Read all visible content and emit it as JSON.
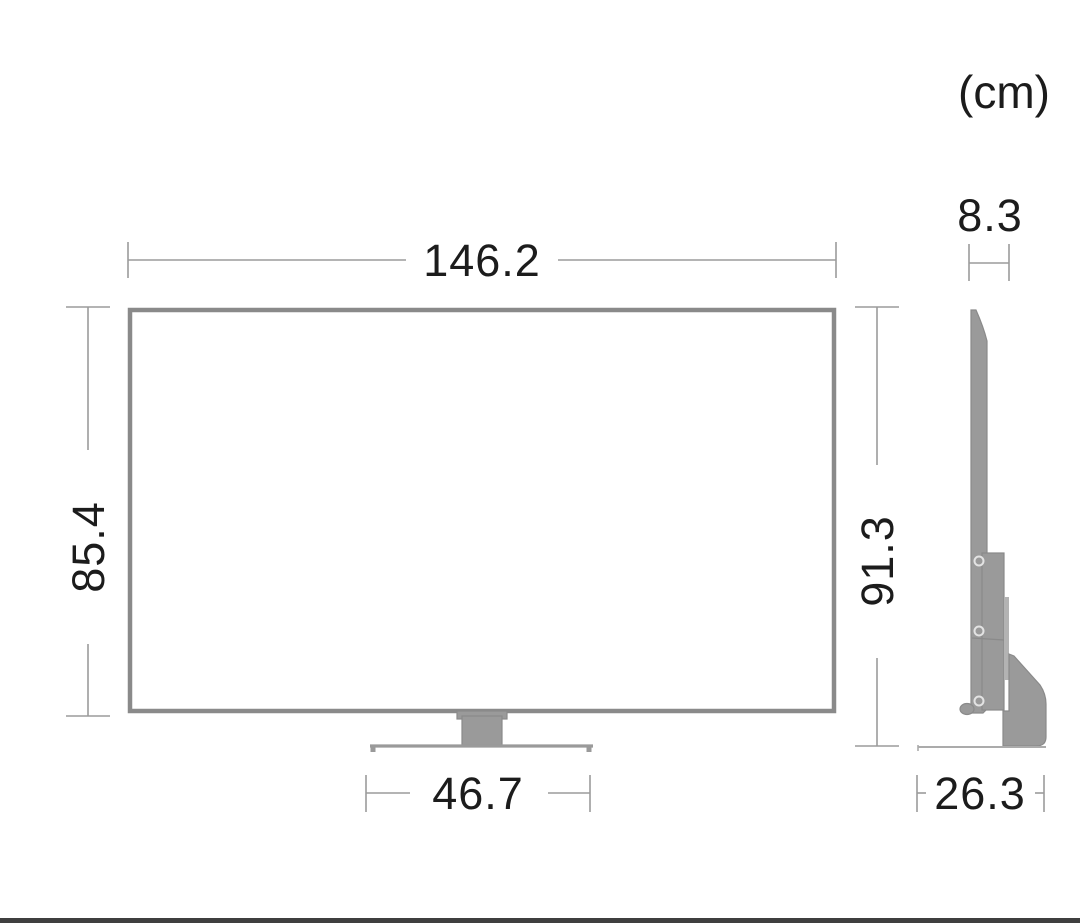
{
  "title": "TV dimensions diagram",
  "unit_label": "(cm)",
  "views": {
    "front": {
      "width_cm": "146.2",
      "panel_height_cm": "85.4",
      "total_height_cm": "91.3",
      "stand_width_cm": "46.7"
    },
    "side": {
      "depth_cm": "8.3",
      "base_depth_cm": "26.3"
    }
  },
  "colors": {
    "background": "#ffffff",
    "outline_gray": "#8a8a8a",
    "fill_gray": "#9a9a9a",
    "dimension_line_gray": "#9b9b9b",
    "text_dark": "#1c1c1c",
    "footer_bar": "#3f3f3f"
  }
}
